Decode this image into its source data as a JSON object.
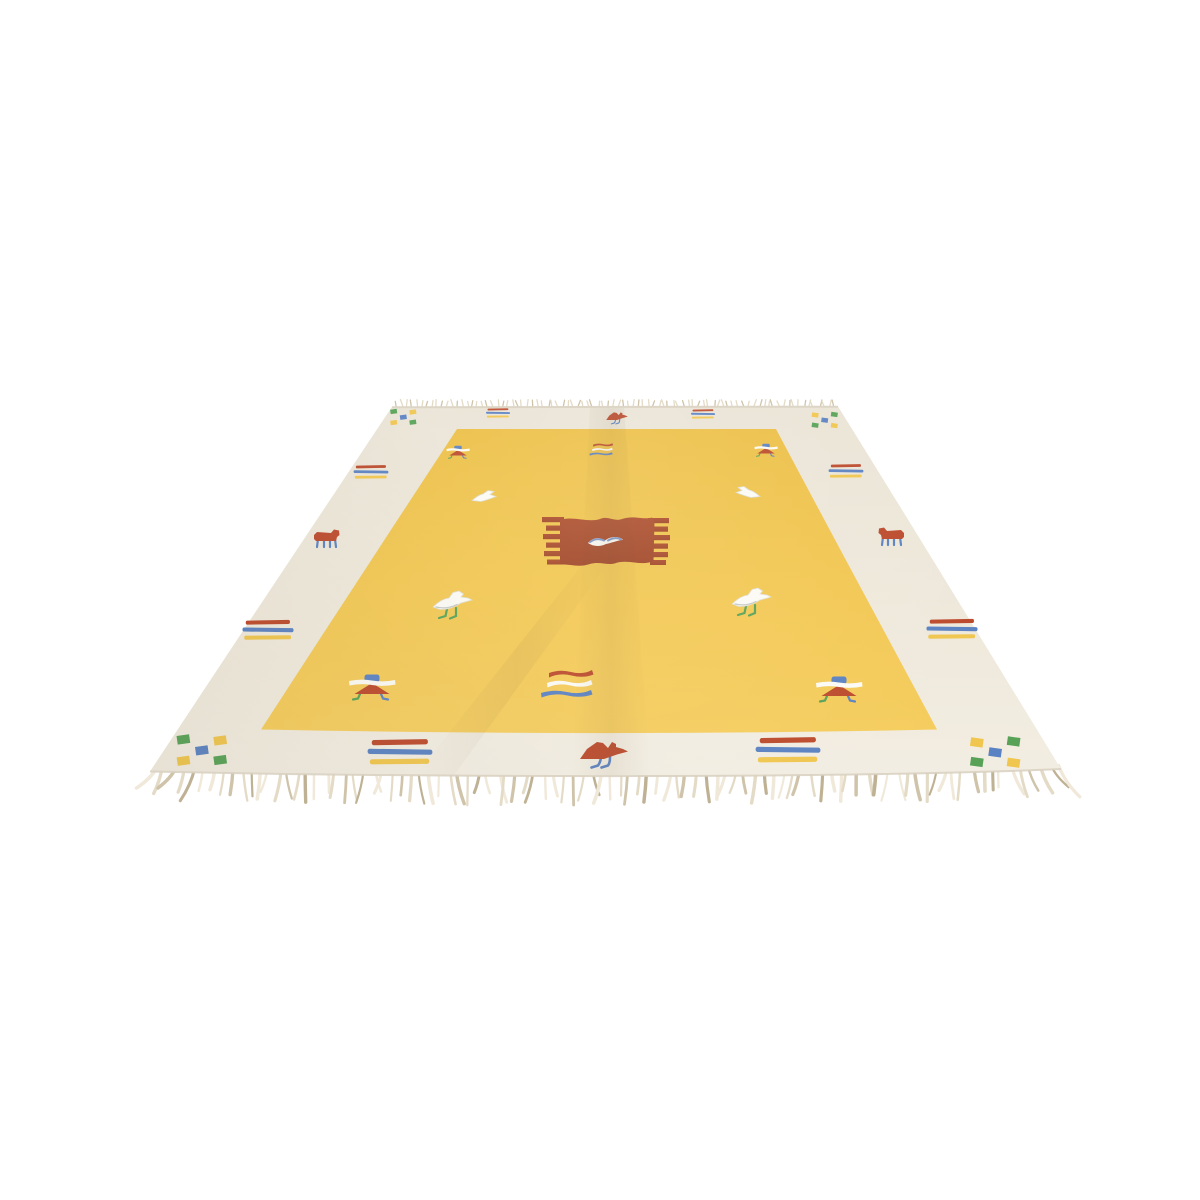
{
  "scene": {
    "type": "product-photo",
    "subject": "Handwoven kilim rug with golden-yellow field, cream border, rust center medallion and small bird motifs, laid flat and photographed in perspective on a plain white studio background",
    "background": "#ffffff"
  },
  "palette": {
    "background": "#ffffff",
    "border_cream": "#efe9dc",
    "border_cream_top": "#eae4d6",
    "border_cream_bottom": "#f3eee3",
    "field_yellow": "#f2c751",
    "field_yellow_top": "#ecbf45",
    "field_yellow_bottom": "#f5cd5f",
    "medallion_rust": "#ad4e2c",
    "medallion_rust_dark": "#a04526",
    "motif_red": "#bc4a2c",
    "motif_blue": "#5b82c2",
    "motif_green": "#57a257",
    "motif_yellow": "#f0c64f",
    "motif_white": "#fbfaf4",
    "edge_line": "#ddd6c6",
    "fringe_light": "#f0e9da",
    "fringe_mid": "#e4dbc7",
    "fringe_dark": "#cfc3aa",
    "fringe_deep": "#bfb193"
  },
  "motif_types": {
    "checker": {
      "desc": "diagonal check of five small squares",
      "colors": [
        "green",
        "yellow",
        "blue"
      ]
    },
    "stripes3": {
      "desc": "three stacked bars",
      "colors": [
        "red",
        "blue",
        "yellow"
      ]
    },
    "wavy3": {
      "desc": "three wavy stripes",
      "colors": [
        "red",
        "white",
        "blue"
      ]
    },
    "bird-red": {
      "desc": "red bird with blue legs"
    },
    "bird-white-sm": {
      "desc": "small white bird"
    },
    "bird-white-lg": {
      "desc": "white bird with green legs"
    },
    "animal": {
      "desc": "small red quadruped with blue legs"
    },
    "tent": {
      "desc": "stylized figure: blue cap, white band, red roof"
    },
    "medallion": {
      "desc": "rust serrated rectangle medallion with white bird at center"
    }
  },
  "rug": {
    "motifs": [
      {
        "type": "checker",
        "name": "corner-checker-top-left",
        "x": 406,
        "y": 417,
        "s": 0.6
      },
      {
        "type": "checker",
        "name": "corner-checker-top-right",
        "x": 822,
        "y": 420,
        "s": 0.6,
        "flip": true
      },
      {
        "type": "checker",
        "name": "corner-checker-bottom-left",
        "x": 207,
        "y": 750,
        "s": 1.15
      },
      {
        "type": "checker",
        "name": "corner-checker-bottom-right",
        "x": 990,
        "y": 752,
        "s": 1.15,
        "flip": true
      },
      {
        "type": "stripes3",
        "name": "border-stripes-top-left",
        "x": 498,
        "y": 413,
        "s": 0.4
      },
      {
        "type": "stripes3",
        "name": "border-stripes-top-right",
        "x": 703,
        "y": 414,
        "s": 0.4
      },
      {
        "type": "stripes3",
        "name": "border-stripes-left-upper",
        "x": 371,
        "y": 472,
        "s": 0.58
      },
      {
        "type": "stripes3",
        "name": "border-stripes-right-upper",
        "x": 846,
        "y": 471,
        "s": 0.58
      },
      {
        "type": "stripes3",
        "name": "border-stripes-left-lower",
        "x": 268,
        "y": 630,
        "s": 0.85
      },
      {
        "type": "stripes3",
        "name": "border-stripes-right-lower",
        "x": 952,
        "y": 629,
        "s": 0.85
      },
      {
        "type": "stripes3",
        "name": "border-stripes-bottom-left",
        "x": 400,
        "y": 752,
        "s": 1.08
      },
      {
        "type": "stripes3",
        "name": "border-stripes-bottom-right",
        "x": 788,
        "y": 750,
        "s": 1.08
      },
      {
        "type": "bird-red",
        "name": "border-bird-top",
        "x": 617,
        "y": 416,
        "s": 0.45
      },
      {
        "type": "bird-red",
        "name": "border-bird-bottom",
        "x": 604,
        "y": 750,
        "s": 1.0
      },
      {
        "type": "animal",
        "name": "border-animal-left",
        "x": 327,
        "y": 539,
        "s": 1.0
      },
      {
        "type": "animal",
        "name": "border-animal-right",
        "x": 891,
        "y": 537,
        "s": 1.0,
        "flip": true
      },
      {
        "type": "wavy3",
        "name": "field-stripes-top",
        "x": 612,
        "y": 450,
        "s": 0.45
      },
      {
        "type": "wavy3",
        "name": "field-stripes-bottom",
        "x": 591,
        "y": 685,
        "s": 1.0
      },
      {
        "type": "tent",
        "name": "field-figure-top-left",
        "x": 458,
        "y": 451,
        "s": 0.5
      },
      {
        "type": "tent",
        "name": "field-figure-top-right",
        "x": 766,
        "y": 449,
        "s": 0.5
      },
      {
        "type": "tent",
        "name": "field-figure-bottom-left",
        "x": 372,
        "y": 685,
        "s": 1.0
      },
      {
        "type": "tent",
        "name": "field-figure-bottom-right",
        "x": 839,
        "y": 687,
        "s": 1.0
      },
      {
        "type": "bird-white-sm",
        "name": "field-bird-upper-left",
        "x": 485,
        "y": 496,
        "s": 1.0
      },
      {
        "type": "bird-white-sm",
        "name": "field-bird-upper-right",
        "x": 747,
        "y": 492,
        "s": 1.0,
        "flip": true
      },
      {
        "type": "bird-white-lg",
        "name": "field-bird-mid-left",
        "x": 455,
        "y": 601,
        "s": 1.0
      },
      {
        "type": "bird-white-lg",
        "name": "field-bird-mid-right",
        "x": 754,
        "y": 598,
        "s": 1.0
      },
      {
        "type": "medallion",
        "name": "center-medallion",
        "x": 606,
        "y": 541,
        "s": 1.0
      }
    ],
    "fringe": {
      "bottom": {
        "count": 96,
        "min_len": 20,
        "max_len": 33
      },
      "top": {
        "count": 88,
        "len": 5
      }
    }
  }
}
